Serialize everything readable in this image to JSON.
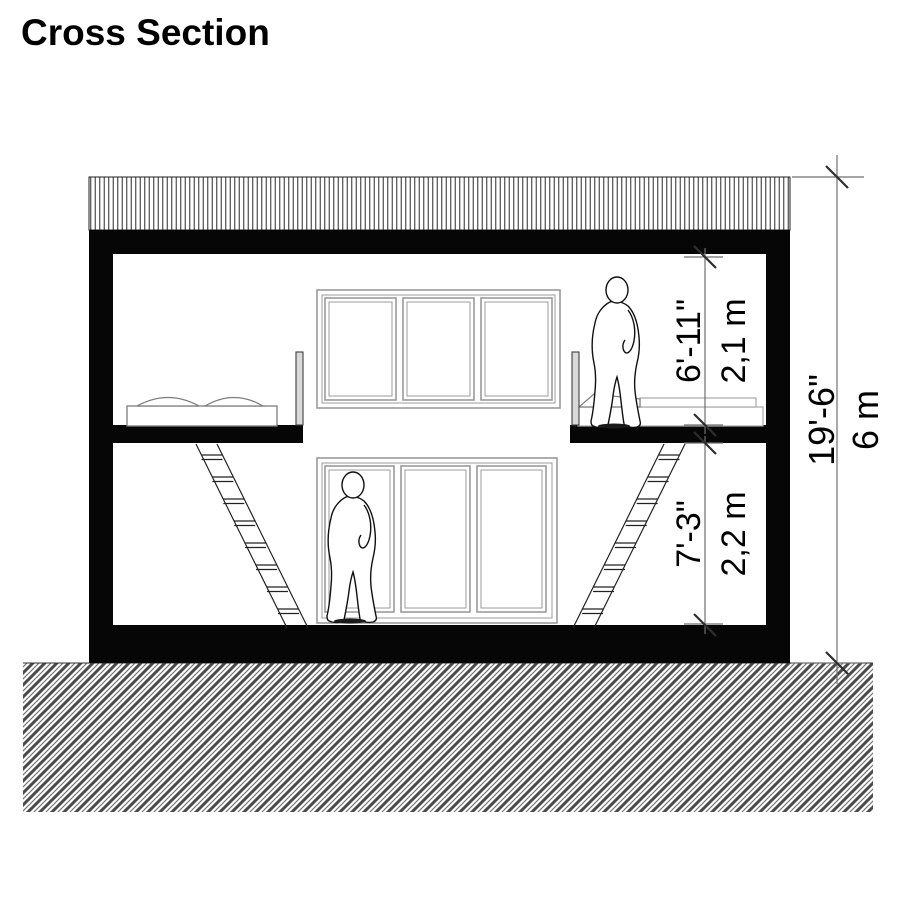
{
  "title": "Cross Section",
  "dimensions": {
    "upper_floor": {
      "imperial": "6'-11\"",
      "metric": "2,1 m"
    },
    "lower_floor": {
      "imperial": "7'-3\"",
      "metric": "2,2 m"
    },
    "overall": {
      "imperial": "19'-6\"",
      "metric": "6 m"
    }
  },
  "colors": {
    "ink": "#000000",
    "wall_fill": "#060606",
    "window_frame": "#9b9b9b",
    "dim_line": "#6e6e6e",
    "tick": "#2e2e2e",
    "hatch": "#3c3c3c"
  }
}
